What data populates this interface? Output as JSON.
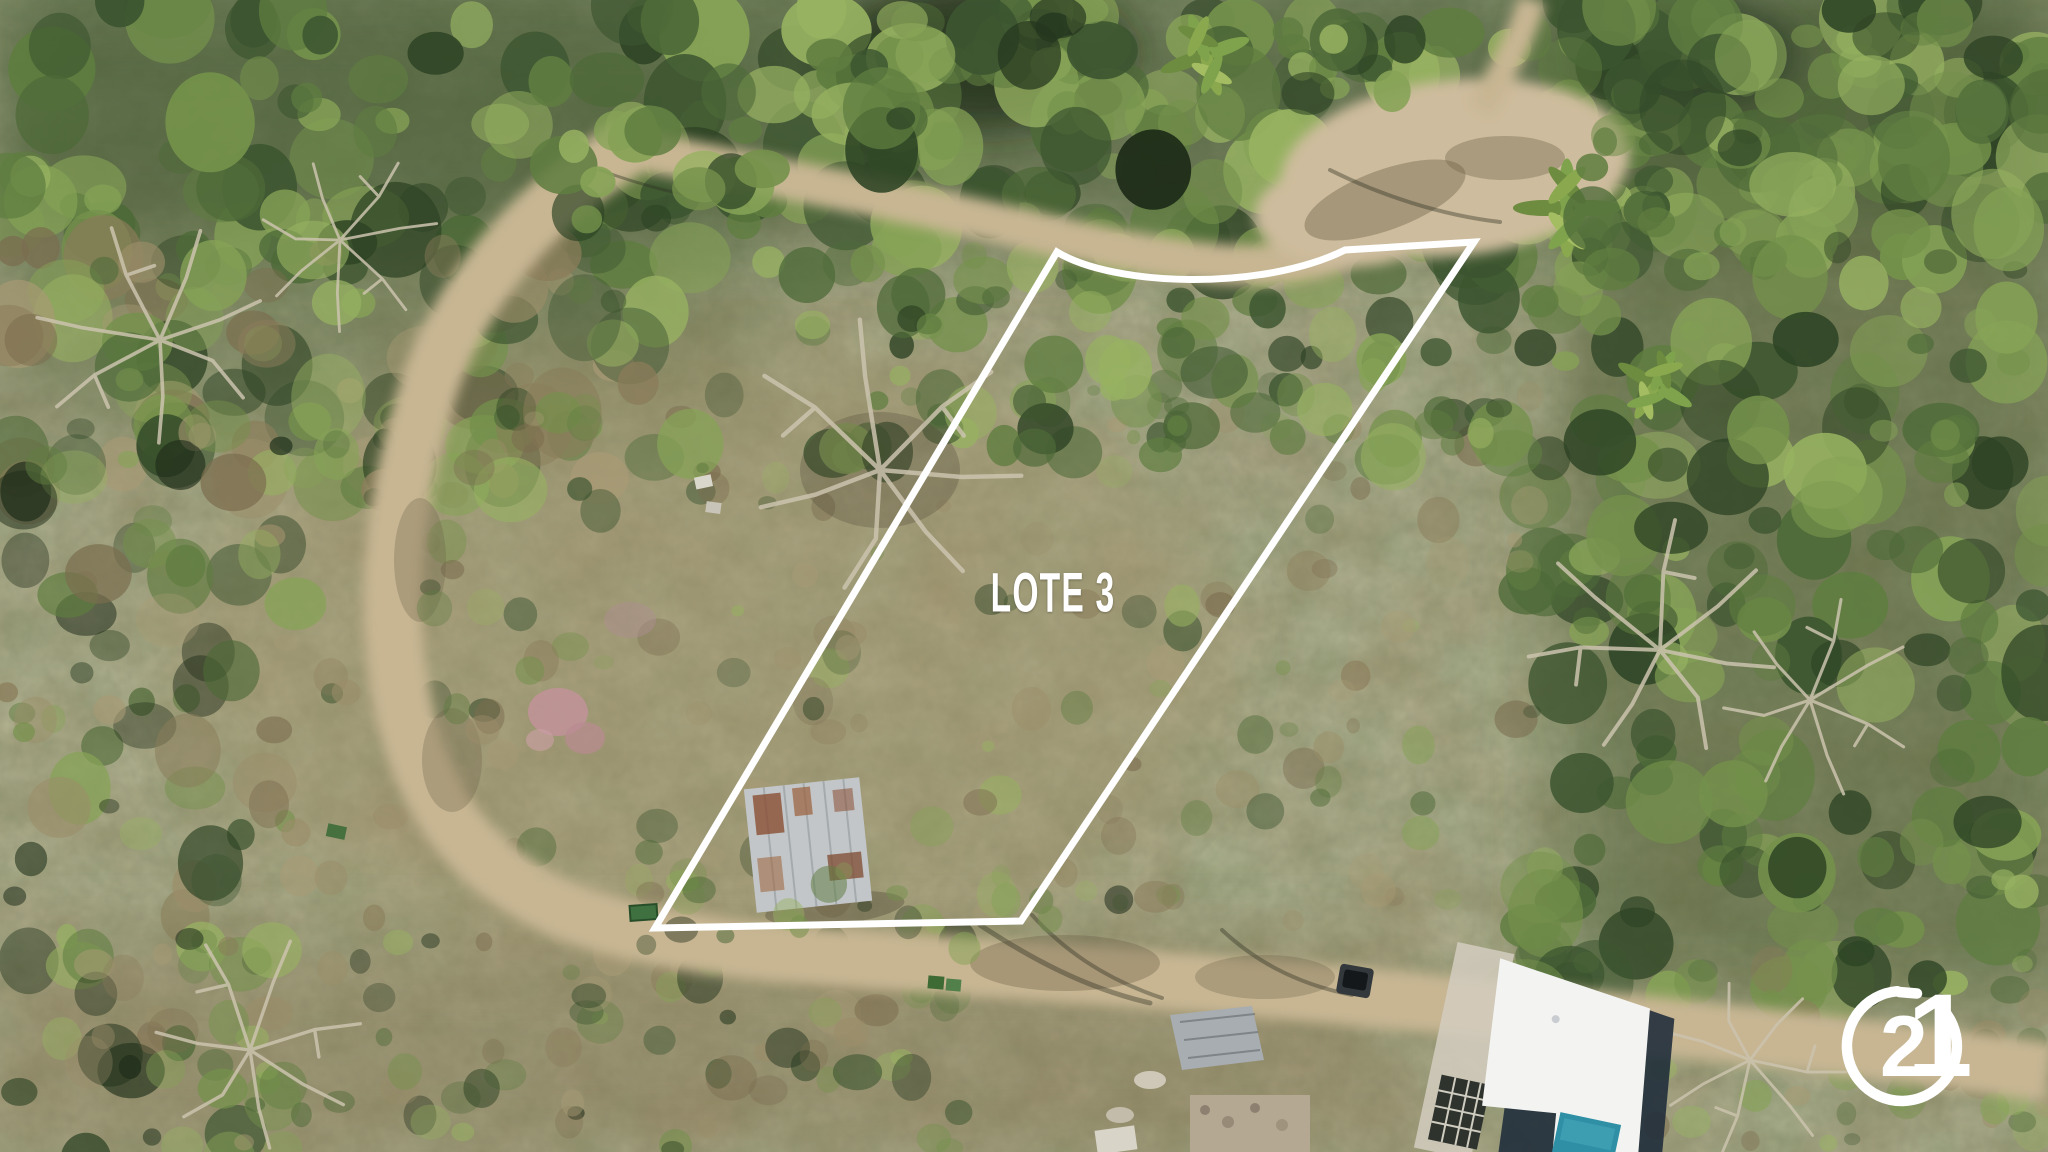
{
  "scene": {
    "description": "Aerial drone photograph of a forested hillside property lot bordered by a dirt road, with an old metal-roof shack inside the lot and a modern white house with pool at lower right"
  },
  "overlay": {
    "lot_label": "LOTE 3",
    "boundary_path": "M 1057 252 C 1115 287 1262 291 1345 250 L 1474 242 L 1021 921 L 655 928 Z"
  },
  "watermark": {
    "brand": "Century 21",
    "digit_first": "2",
    "digit_second": "1"
  },
  "colors": {
    "boundary_white": "#ffffff",
    "label_white": "#ffffff",
    "brand_white": "#ffffff",
    "road_tan": "#c8b693",
    "clearing_sand": "#cdbc9d",
    "scrub_base": "#9a8c68",
    "canopy_green": "#4e6a38",
    "canopy_dark": "#26391f",
    "pool_teal": "#2e8fa5",
    "roof_white": "#f3f4f1",
    "house_shadow": "#1e2b3a",
    "shack_metal": "#c2c6c8",
    "shack_rust": "#8a4f33",
    "flower_pink": "#c29399"
  }
}
